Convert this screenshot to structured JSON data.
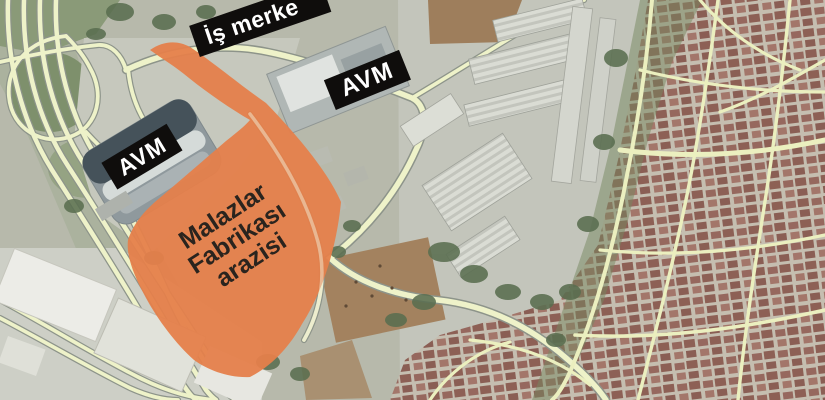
{
  "labels": {
    "business_center": "İş merke",
    "avm_left": "AVM",
    "avm_right": "AVM",
    "parcel_line1": "Malazlar",
    "parcel_line2": "Fabrikası",
    "parcel_line3": "arazisi"
  },
  "colors": {
    "parcel_fill": "#e57f4b",
    "parcel_text": "#2a241e",
    "label_bg": "#0f0d0c",
    "label_text": "#ffffff",
    "road_fill": "#eef2c9",
    "road_casing": "#8d948a",
    "street": "#ebefbf",
    "ground": "#b7b9ab",
    "rooftop": "#96685e",
    "greenery": "#7e906c"
  }
}
